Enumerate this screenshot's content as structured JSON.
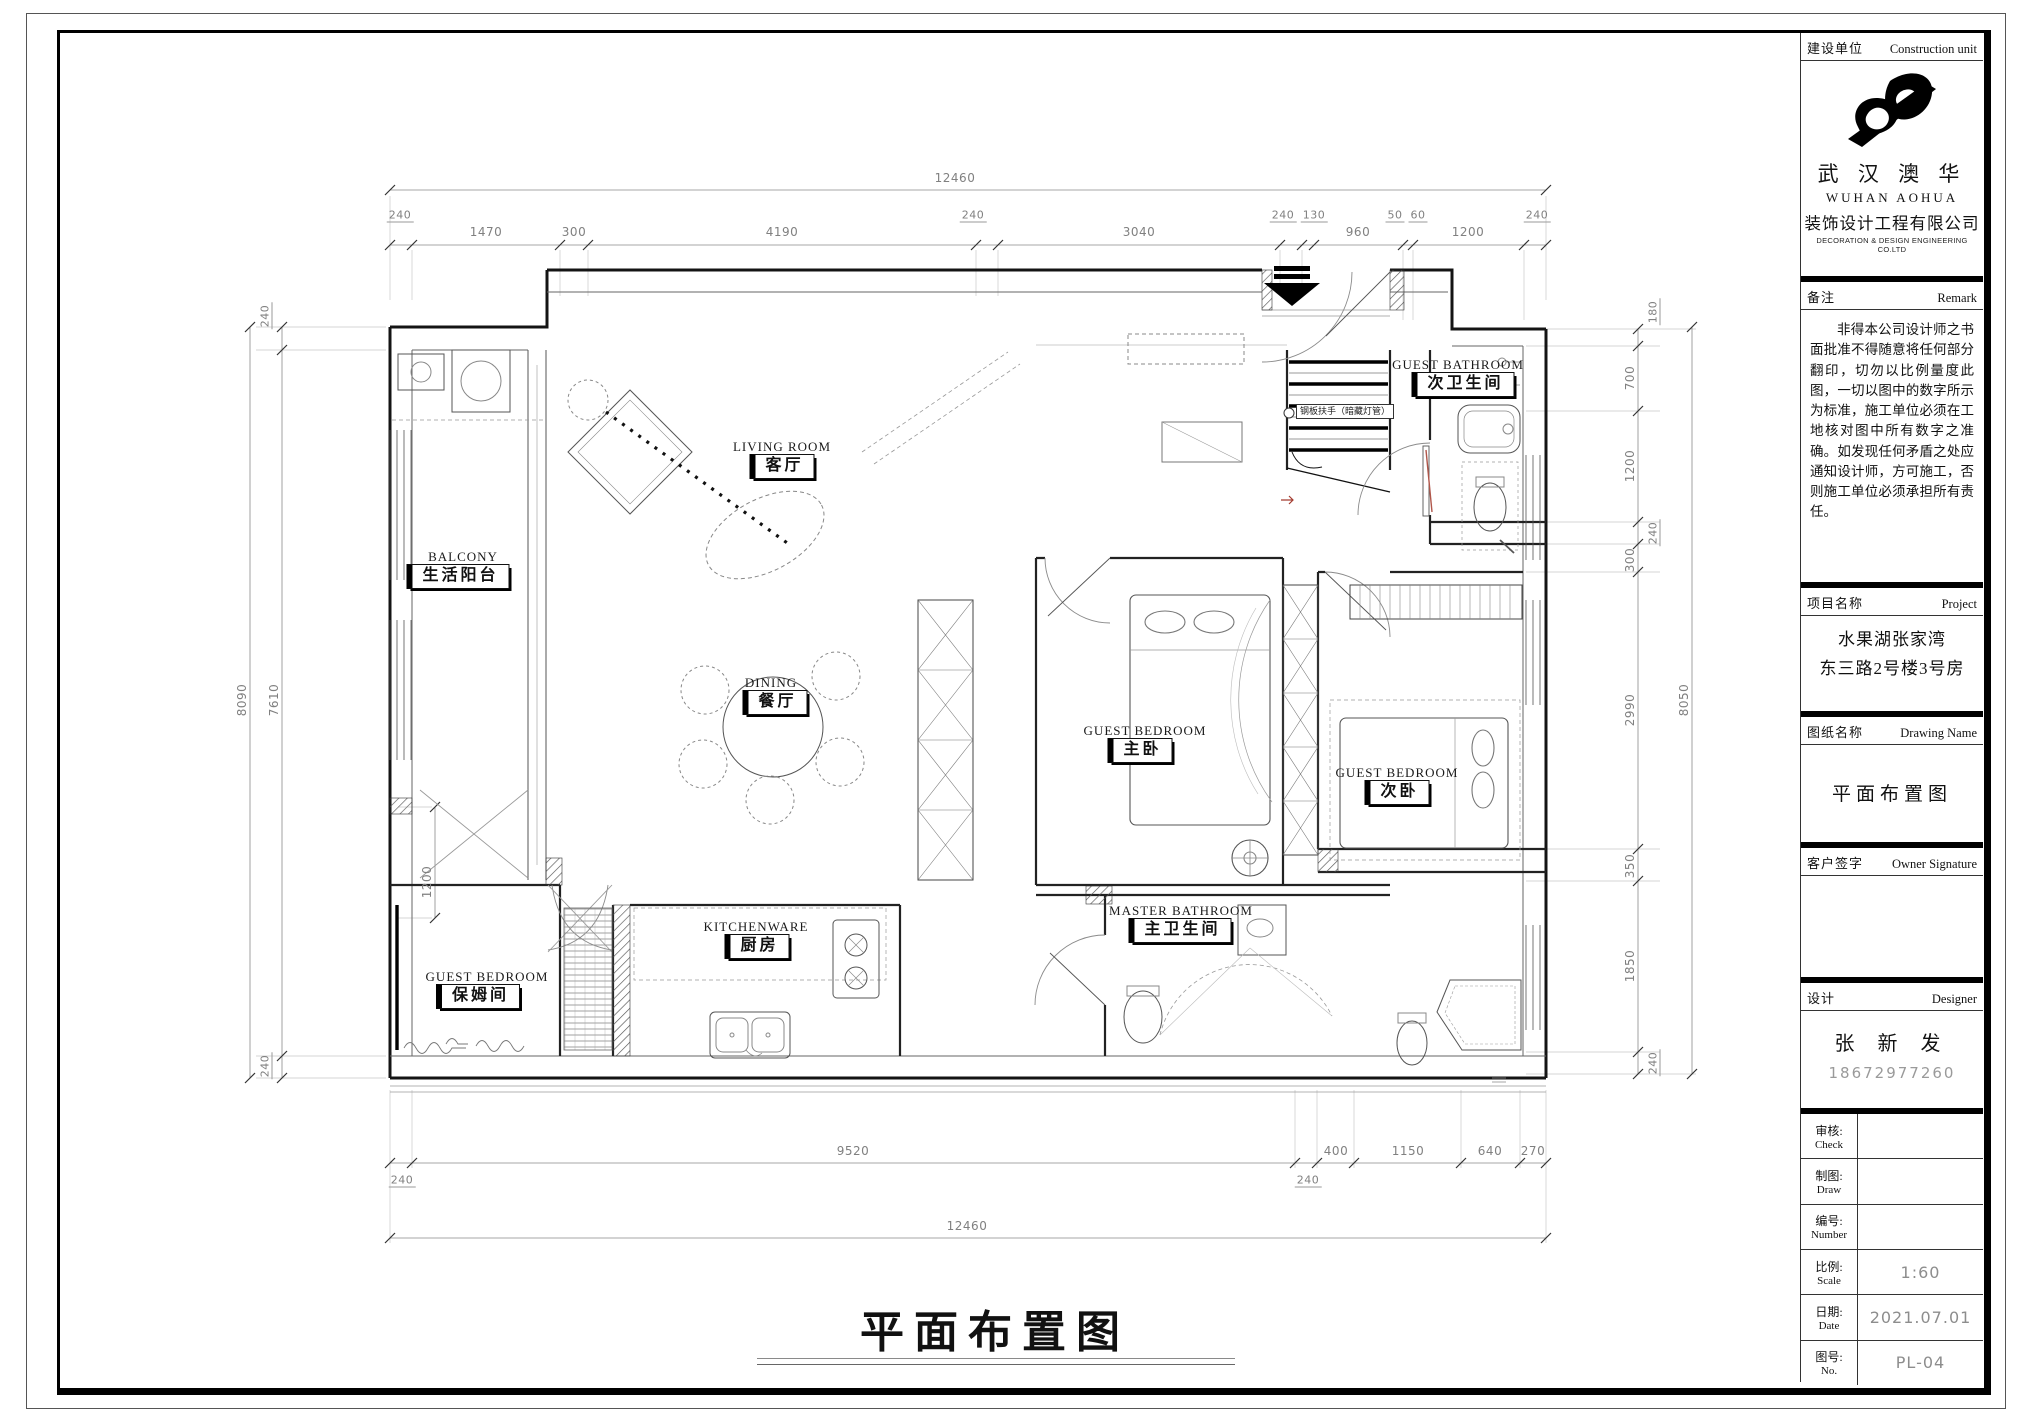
{
  "sheet": {
    "bottom_title": "平面布置图"
  },
  "title_block": {
    "construction_unit": {
      "label_cn": "建设单位",
      "label_en": "Construction unit"
    },
    "company": {
      "cn_name": "武 汉 澳 华",
      "en_name": "WUHAN  AOHUA",
      "cn_sub": "装饰设计工程有限公司",
      "en_sub": "DECORATION & DESIGN ENGINEERING  CO.LTD"
    },
    "remark": {
      "label_cn": "备注",
      "label_en": "Remark",
      "text": "非得本公司设计师之书面批准不得随意将任何部分翻印，切勿以比例量度此图，一切以图中的数字所示为标准，施工单位必须在工地核对图中所有数字之准确。如发现任何矛盾之处应通知设计师，方可施工，否则施工单位必须承担所有责任。"
    },
    "project": {
      "label_cn": "项目名称",
      "label_en": "Project",
      "line1": "水果湖张家湾",
      "line2": "东三路2号楼3号房"
    },
    "drawing": {
      "label_cn": "图纸名称",
      "label_en": "Drawing Name",
      "value": "平面布置图"
    },
    "signature": {
      "label_cn": "客户签字",
      "label_en": "Owner Signature"
    },
    "designer": {
      "label_cn": "设计",
      "label_en": "Designer",
      "name": "张 新 发",
      "phone": "18672977260"
    },
    "table": {
      "check_cn": "审核:",
      "check_en": "Check",
      "check_value": "",
      "draw_cn": "制图:",
      "draw_en": "Draw",
      "draw_value": "",
      "number_cn": "编号:",
      "number_en": "Number",
      "number_value": "",
      "scale_cn": "比例:",
      "scale_en": "Scale",
      "scale_value": "1:60",
      "date_cn": "日期:",
      "date_en": "Date",
      "date_value": "2021.07.01",
      "no_cn": "图号:",
      "no_en": "No.",
      "no_value": "PL-04"
    }
  },
  "rooms": [
    {
      "en": "LIVING ROOM",
      "cn": "客厅"
    },
    {
      "en": "BALCONY",
      "cn": "生活阳台"
    },
    {
      "en": "DINING",
      "cn": "餐厅"
    },
    {
      "en": "GUEST BEDROOM",
      "cn": "主卧"
    },
    {
      "en": "GUEST BEDROOM",
      "cn": "次卧"
    },
    {
      "en": "GUEST BATHROOM",
      "cn": "次卫生间"
    },
    {
      "en": "MASTER BATHROOM",
      "cn": "主卫生间"
    },
    {
      "en": "KITCHENWARE",
      "cn": "厨房"
    },
    {
      "en": "GUEST BEDROOM",
      "cn": "保姆间"
    }
  ],
  "notes": {
    "handrail": "钢板扶手（暗藏灯管）"
  },
  "dims": {
    "overall": "12460",
    "top": [
      "240",
      "1470",
      "300",
      "4190",
      "240",
      "3040",
      "240",
      "130",
      "960",
      "50",
      "60",
      "1200",
      "240"
    ],
    "bottom": [
      "240",
      "9520",
      "240",
      "400",
      "1150",
      "640",
      "270"
    ],
    "left": [
      "240",
      "7610",
      "240"
    ],
    "left_outer": "8090",
    "balcony_inner": "1200",
    "right": [
      "180",
      "700",
      "1200",
      "240",
      "300",
      "2990",
      "350",
      "1850",
      "240"
    ],
    "right_outer": "8050"
  }
}
